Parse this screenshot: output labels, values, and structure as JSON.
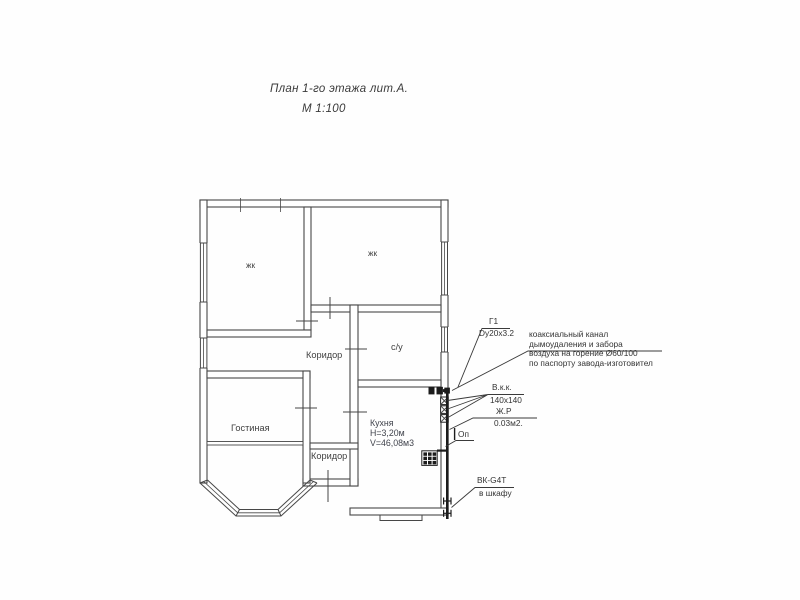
{
  "title": {
    "line1": "План 1-го этажа лит.А.",
    "line2": "М 1:100"
  },
  "rooms": {
    "zhk1": "жк",
    "zhk2": "жк",
    "koridor_main": "Коридор",
    "su": "с/у",
    "gostinaya": "Гостиная",
    "koridor_small": "Коридор",
    "kitchen": {
      "name": "Кухня",
      "height": "Н=3,20м",
      "volume": "V=46,08м3"
    }
  },
  "annotations": {
    "gas_riser": {
      "label": "Г1",
      "spec": "Dy20x3.2"
    },
    "coax": {
      "line1": "коаксиальный канал",
      "line2": "дымоудаления и забора",
      "line3": "воздуха на горение Ø60/100",
      "line4": "по паспорту завода-изготовител"
    },
    "vent_channel": {
      "label": "В.к.к.",
      "size": "140x140"
    },
    "grille": {
      "label": "Ж.Р",
      "size": "0.03м2."
    },
    "drop": {
      "label": "Оп"
    },
    "meter": {
      "label": "ВК-G4T",
      "location": "в шкафу"
    }
  },
  "colors": {
    "line": "#474747",
    "ink": "#3d3d3d",
    "pipe": "#1c1c1c",
    "background": "#ffffff"
  }
}
